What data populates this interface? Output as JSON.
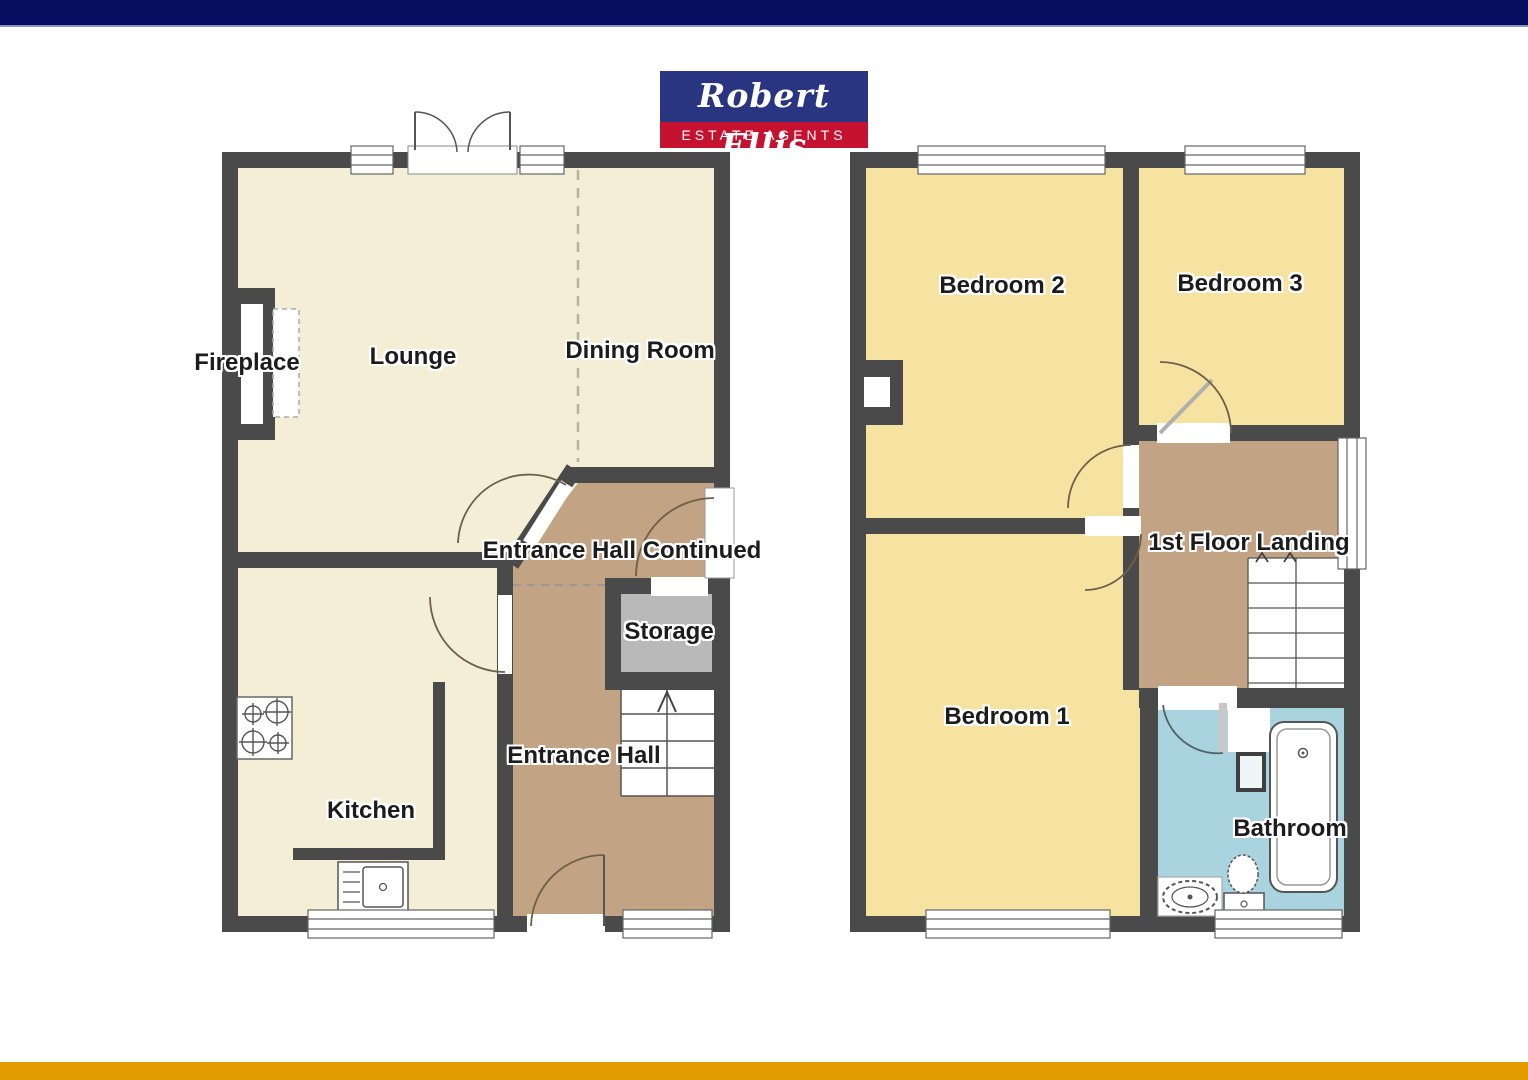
{
  "brand": {
    "name": "Robert Ellis",
    "tagline": "ESTATE AGENTS",
    "logo_bg": "#2a3582",
    "tagline_bg": "#c51230"
  },
  "page": {
    "background": "#ffffff",
    "top_bar_color": "#050e5e",
    "bottom_bar_color": "#e29b00"
  },
  "palette": {
    "wall": "#4a4a4a",
    "ground_floor_room": "#f5eed7",
    "hall": "#c2a383",
    "bedroom": "#f6e3a2",
    "bathroom": "#a9d3de",
    "storage": "#b9b9b9",
    "door_arc": "#6e5f49"
  },
  "rooms": {
    "lounge": "Lounge",
    "dining_room": "Dining Room",
    "fireplace": "Fireplace",
    "kitchen": "Kitchen",
    "entrance_hall": "Entrance Hall",
    "entrance_hall_continued": "Entrance Hall Continued",
    "storage": "Storage",
    "bedroom_1": "Bedroom 1",
    "bedroom_2": "Bedroom 2",
    "bedroom_3": "Bedroom 3",
    "landing": "1st Floor Landing",
    "bathroom": "Bathroom"
  }
}
